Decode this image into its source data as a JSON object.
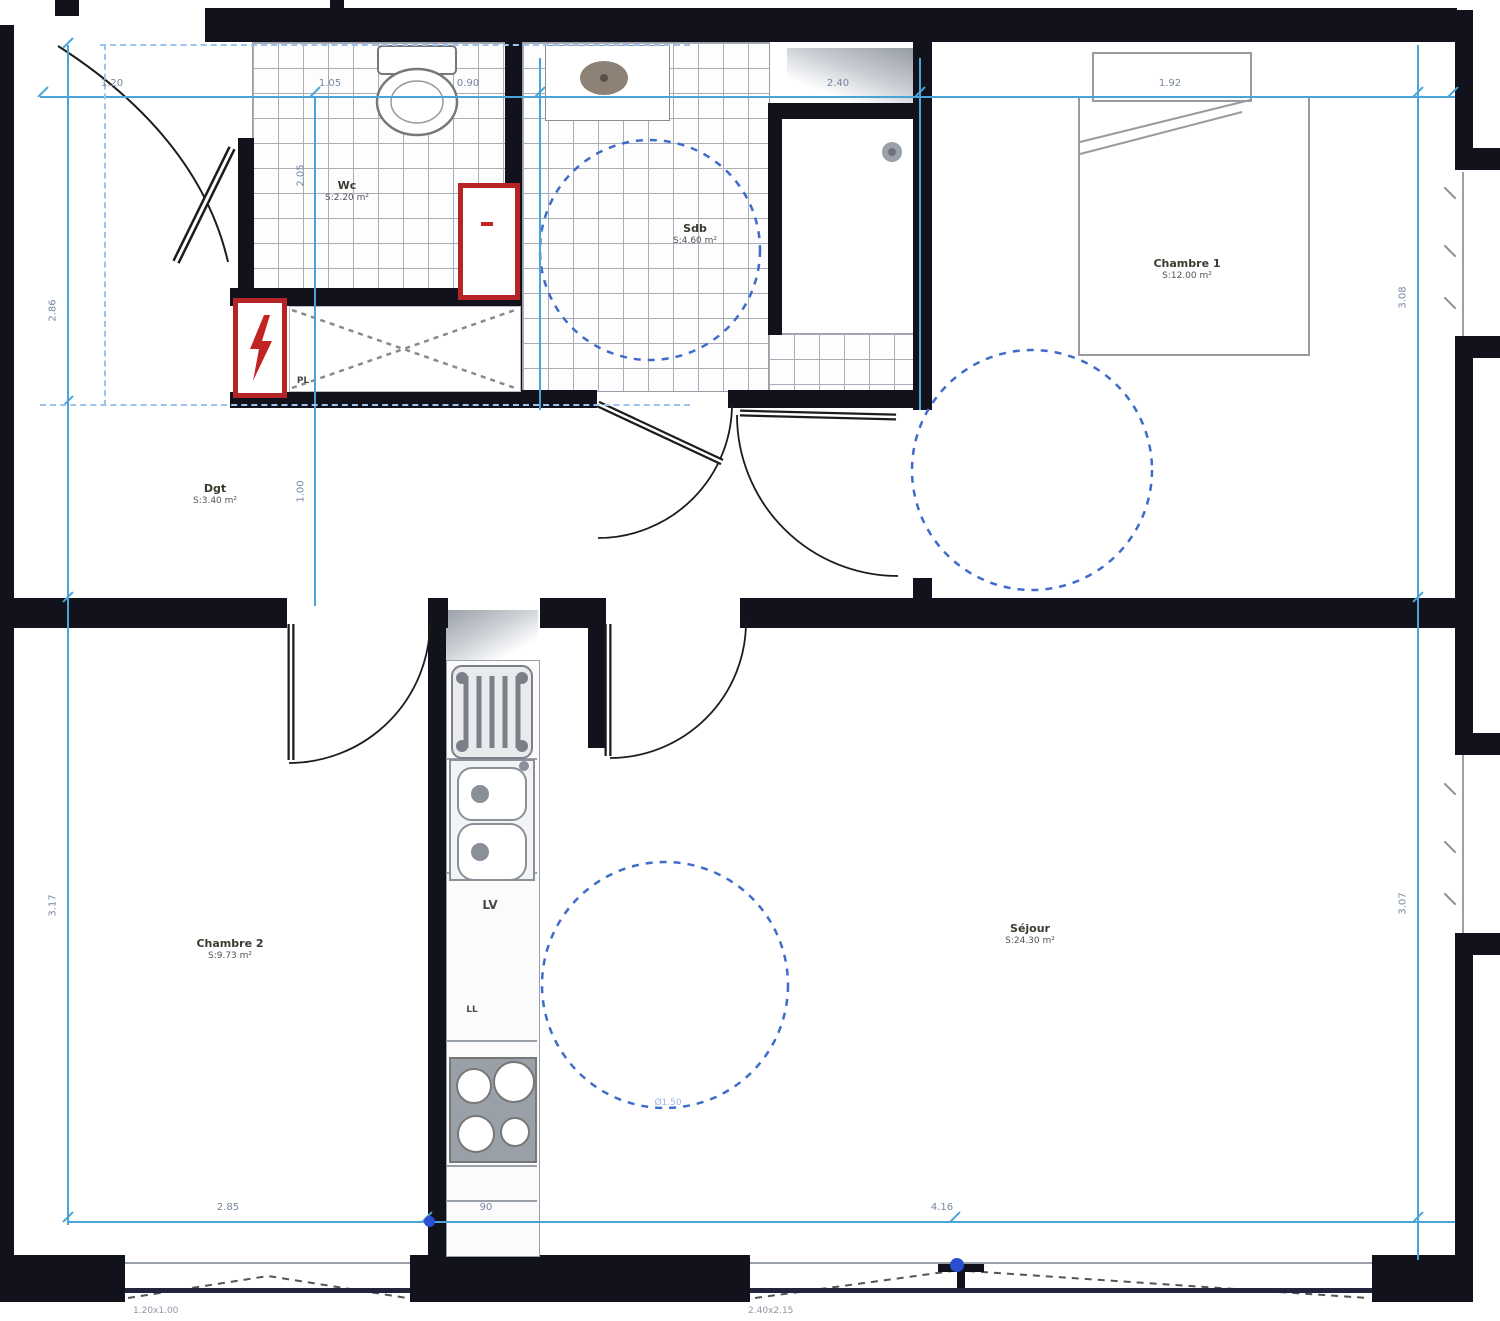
{
  "plan": {
    "rooms": {
      "wc": {
        "name": "Wc",
        "area": "S:2.20 m²"
      },
      "sdb": {
        "name": "Sdb",
        "area": "S:4.60 m²"
      },
      "chambre1": {
        "name": "Chambre 1",
        "area": "S:12.00 m²"
      },
      "dgt": {
        "name": "Dgt",
        "area": "S:3.40 m²"
      },
      "chambre2": {
        "name": "Chambre 2",
        "area": "S:9.73 m²"
      },
      "sejour": {
        "name": "Séjour",
        "area": "S:24.30 m²"
      }
    },
    "fixtures": {
      "dishwasher": "LV",
      "washing_machine": "LL",
      "closet": "PL"
    },
    "dimensions": {
      "top": [
        "1.20",
        "1.05",
        "0.90",
        "2.40",
        "1.92"
      ],
      "left": [
        "2.86",
        "3.17"
      ],
      "inner": [
        "2.05",
        "1.00"
      ],
      "right": [
        "3.08",
        "3.07"
      ],
      "bottom": [
        "2.85",
        "90",
        "4.16"
      ],
      "turning_circle": "Ø1.50",
      "window_notes": [
        "1.20x1.00",
        "2.40x2.15"
      ]
    },
    "colors": {
      "wall": "#12121c",
      "dimension_line": "#4aa4d8",
      "dashed_guide": "#9ec3ec",
      "accessibility_circle": "#3f6cc8",
      "technical_red": "#b52525",
      "tile_line": "#a8adb6"
    }
  }
}
